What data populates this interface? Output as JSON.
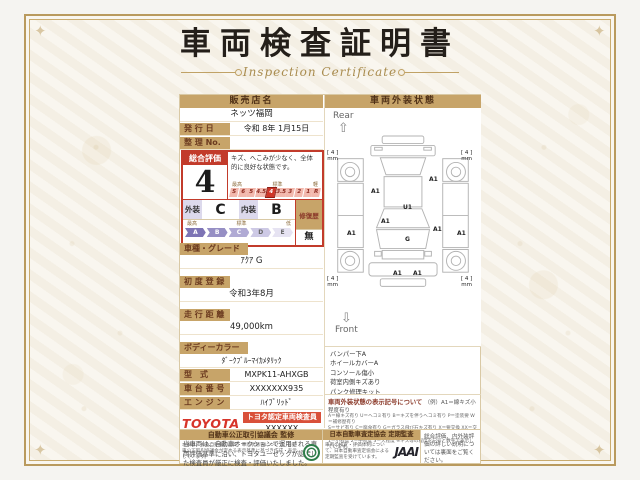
{
  "colors": {
    "gold": "#b99a5e",
    "tan": "#c7a469",
    "red": "#c23b2b",
    "toyota_red": "#d7352a",
    "stamp_green": "#2f7d4a"
  },
  "title": {
    "main": "車両検査証明書",
    "sub": "Inspection Certificate"
  },
  "seller": {
    "header": "販売店名",
    "name": "ネッツ福岡",
    "issue_label": "発 行 日",
    "issue_value": "令和 8年 1月15日",
    "ref_label": "整 理 No.",
    "ref_value": ""
  },
  "evaluation": {
    "overall_label": "総合評価",
    "grade": "4",
    "comment": "キズ、へこみが少なく、全体的に良好な状態です。",
    "numeric_scale": {
      "left": "最高",
      "mid": "標準",
      "right": "軽",
      "items": [
        "S",
        "6",
        "5",
        "4.5",
        "4",
        "3.5",
        "3",
        "2",
        "1",
        "R"
      ],
      "selected": "4"
    },
    "exterior_label": "外装",
    "exterior_grade": "C",
    "interior_label": "内装",
    "interior_grade": "B",
    "repair_label": "修復歴",
    "repair_value": "無",
    "letter_scale": {
      "left": "最高",
      "mid": "標準",
      "right": "低",
      "items": [
        "A",
        "B",
        "C",
        "D",
        "E"
      ]
    }
  },
  "fields": {
    "model_label": "車種・グレード",
    "model_value": "ｱｸｱ G",
    "firstreg_label": "初 度 登 録",
    "firstreg_value": "令和3年8月",
    "mileage_label": "走 行 距 離",
    "mileage_value": "49,000km",
    "color_label": "ボディーカラー",
    "color_value": "ﾀﾞｰｸﾌﾞﾙｰﾏｲｶﾒﾀﾘｯｸ",
    "type_label": "型　式",
    "type_value": "MXPK11-AHXGB",
    "chassis_label": "車 台 番 号",
    "chassis_value": "XXXXXXX935",
    "engine_label": "エ ン ジ ン",
    "engine_value": "ﾊｲﾌﾞﾘｯﾄﾞ"
  },
  "inspector": {
    "brand": "TOYOTA",
    "cert_label": "トヨタ認定車両検査員",
    "cert_no": "XXXXXX"
  },
  "disclaimer": "当車両は、自動車オークションで運用される車両評価基準に沿い、トヨタユーゼックが認定した検査員が厳正に検査・評価いたしました。",
  "exterior": {
    "header": "車両外装状態",
    "rear": "Rear",
    "front": "Front",
    "marks": [
      "A1",
      "A1",
      "A1",
      "U1",
      "A1",
      "A1",
      "A1",
      "G",
      "A1",
      "A1"
    ],
    "tire": "[ 4 ]\nmm",
    "notes": [
      "バンパー下A",
      "ホイールカバーA",
      "コンソール傷小",
      "荷室内側キズあり",
      "パンク修理キット"
    ],
    "legend_header": "車両外装状態の表示記号について",
    "legend_example": "（例）A1＝線キズ小程度有り",
    "legend_lines": [
      "A＝線キズ有り U＝ヘコミ有り B＝キズを伴うヘコミ有り P＝塗装要 W＝補修歴有り",
      "S＝サビ有り C＝腐食有り G＝ガラス飛び石キズ有り X＝要交換 XX＝交換歴有り",
      "1＝小程度 2＝中程度 3＝大程度 ※キズ等の程度を記号と数字で表示しています。"
    ]
  },
  "footer": {
    "fair_header": "自動車公正取引協議会 監修",
    "fair_text": "本表は、中古自動車の品質・車両状態等について、自動車公正取引協議会が定める表示基準に基づき作成・表示しています。",
    "jaai_header": "日本自動車査定協会 定期監査",
    "jaai_text": "車両の検査・評価体制について、日本自動車査定協会による定期監査を受けています。",
    "jaai_logo": "JAAI",
    "back_note": "総合評価、内外装評価の詳しい説明については裏面をご覧ください。"
  }
}
